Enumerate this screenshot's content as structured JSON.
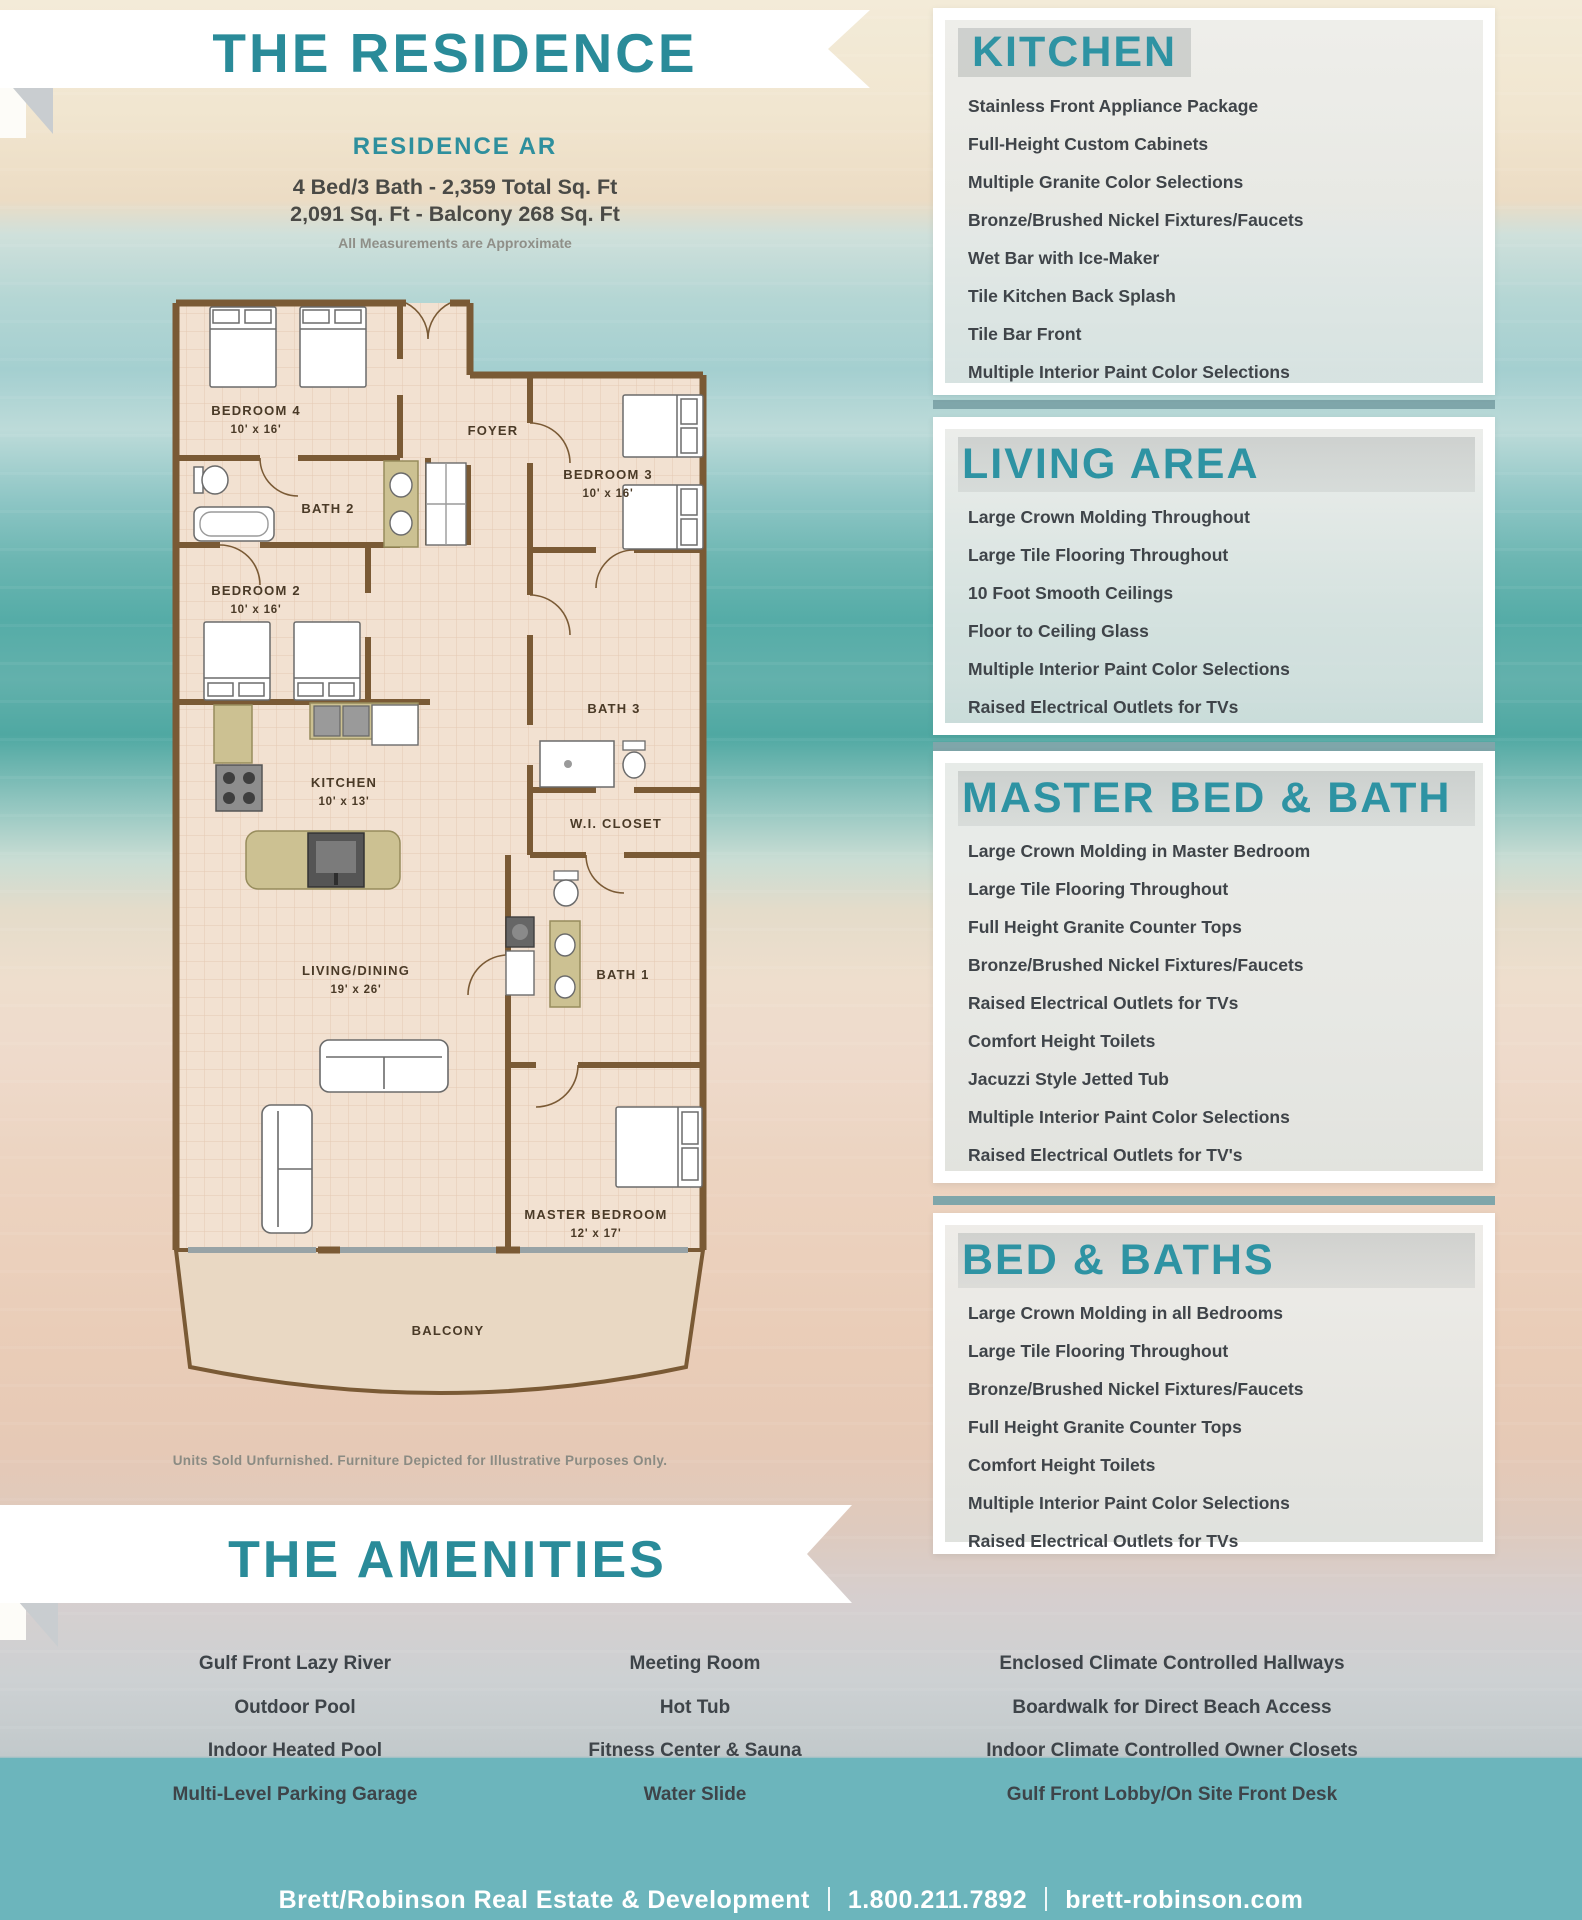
{
  "header": {
    "title": "THE RESIDENCE",
    "residence_name": "RESIDENCE AR",
    "spec_line1": "4 Bed/3 Bath - 2,359 Total Sq. Ft",
    "spec_line2": "2,091 Sq. Ft - Balcony 268 Sq. Ft",
    "note": "All Measurements are Approximate"
  },
  "floorplan": {
    "disclaimer": "Units Sold Unfurnished. Furniture Depicted for Illustrative Purposes Only.",
    "rooms": [
      {
        "label": "BEDROOM 4",
        "dims": "10' x 16'"
      },
      {
        "label": "FOYER",
        "dims": ""
      },
      {
        "label": "BEDROOM 3",
        "dims": "10' x 16'"
      },
      {
        "label": "BATH 2",
        "dims": ""
      },
      {
        "label": "BEDROOM 2",
        "dims": "10' x 16'"
      },
      {
        "label": "KITCHEN",
        "dims": "10' x 13'"
      },
      {
        "label": "BATH 3",
        "dims": ""
      },
      {
        "label": "W.I. CLOSET",
        "dims": ""
      },
      {
        "label": "BATH 1",
        "dims": ""
      },
      {
        "label": "LIVING/DINING",
        "dims": "19' x 26'"
      },
      {
        "label": "MASTER BEDROOM",
        "dims": "12' x 17'"
      },
      {
        "label": "BALCONY",
        "dims": ""
      }
    ]
  },
  "feature_sections": [
    {
      "title": "KITCHEN",
      "items": [
        "Stainless Front Appliance Package",
        "Full-Height Custom Cabinets",
        "Multiple Granite Color Selections",
        "Bronze/Brushed Nickel Fixtures/Faucets",
        "Wet Bar with Ice-Maker",
        "Tile Kitchen Back Splash",
        "Tile Bar Front",
        "Multiple Interior Paint Color Selections"
      ]
    },
    {
      "title": "LIVING AREA",
      "items": [
        "Large Crown Molding Throughout",
        "Large Tile Flooring Throughout",
        "10 Foot Smooth Ceilings",
        "Floor to Ceiling Glass",
        "Multiple Interior Paint Color Selections",
        "Raised Electrical Outlets for TVs"
      ]
    },
    {
      "title": "MASTER BED & BATH",
      "items": [
        "Large Crown Molding in Master Bedroom",
        "Large Tile Flooring Throughout",
        "Full Height Granite Counter Tops",
        "Bronze/Brushed Nickel Fixtures/Faucets",
        "Raised Electrical Outlets for TVs",
        "Comfort Height Toilets",
        "Jacuzzi Style Jetted Tub",
        "Multiple Interior Paint Color Selections",
        "Raised Electrical Outlets for TV's"
      ]
    },
    {
      "title": "BED & BATHS",
      "items": [
        "Large Crown Molding in all Bedrooms",
        "Large Tile Flooring Throughout",
        "Bronze/Brushed Nickel Fixtures/Faucets",
        "Full Height Granite Counter Tops",
        "Comfort Height Toilets",
        "Multiple Interior Paint Color Selections",
        "Raised Electrical Outlets for TVs"
      ]
    }
  ],
  "amenities": {
    "title": "THE AMENITIES",
    "columns": [
      [
        "Gulf Front Lazy River",
        "Outdoor Pool",
        "Indoor Heated Pool",
        "Multi-Level Parking Garage"
      ],
      [
        "Meeting Room",
        "Hot Tub",
        "Fitness Center & Sauna",
        "Water Slide"
      ],
      [
        "Enclosed Climate Controlled Hallways",
        "Boardwalk for Direct Beach Access",
        "Indoor Climate Controlled Owner Closets",
        "Gulf Front Lobby/On Site Front Desk"
      ]
    ]
  },
  "footer": {
    "company": "Brett/Robinson Real Estate & Development",
    "phone": "1.800.211.7892",
    "website": "brett-robinson.com"
  },
  "colors": {
    "teal_heading": "#2e93a3",
    "footer_band": "#6cb5bc",
    "list_text": "#3f4449",
    "wall_brown": "#7a5a35"
  }
}
